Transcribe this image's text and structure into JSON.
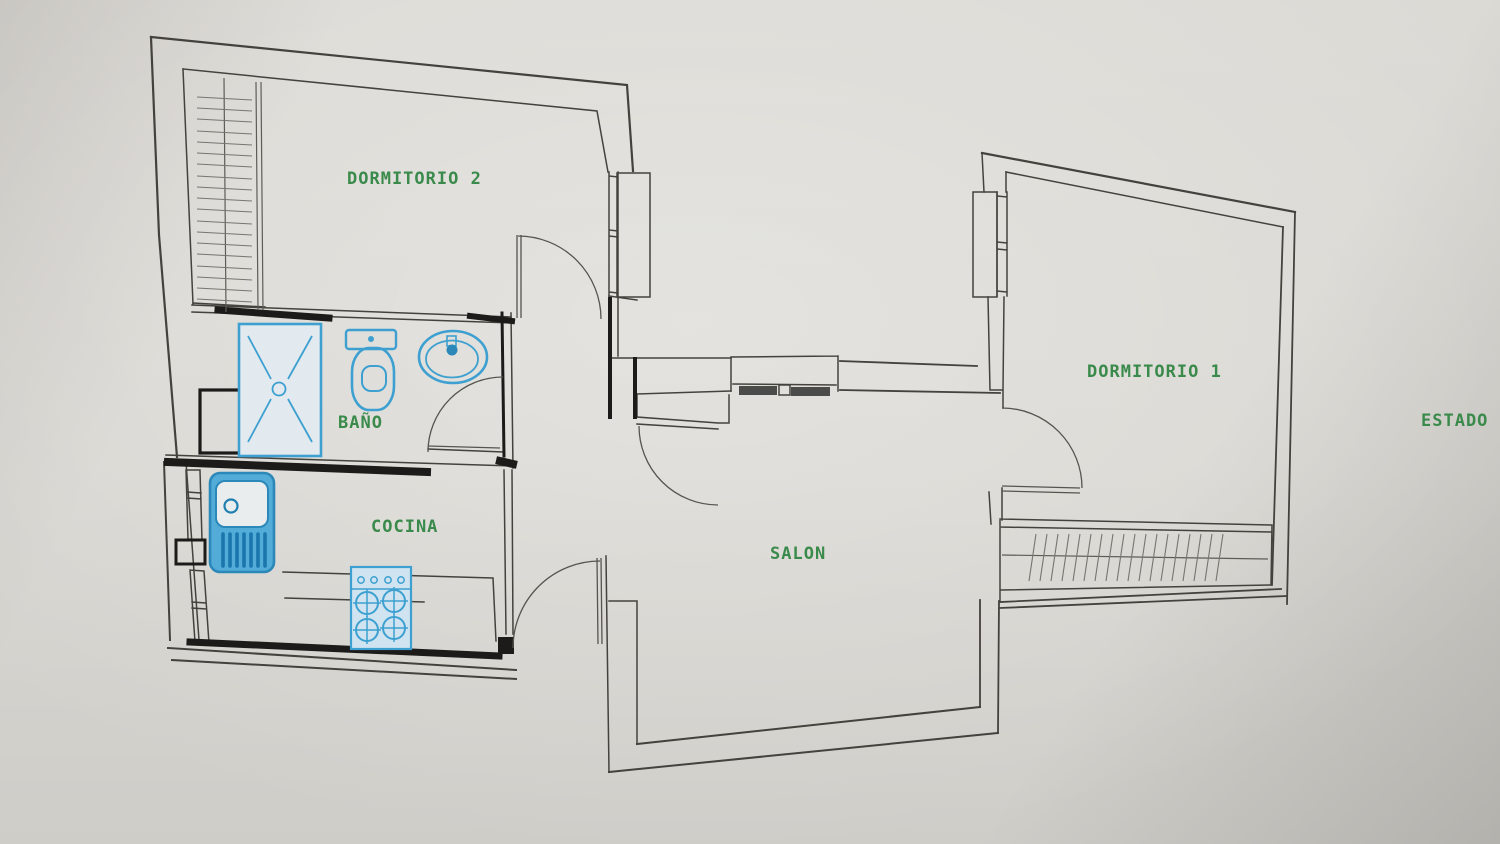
{
  "plan": {
    "type": "apartment-floor-plan",
    "rooms": [
      {
        "label": "DORMITORIO 2"
      },
      {
        "label": "BAÑO"
      },
      {
        "label": "COCINA"
      },
      {
        "label": "SALON"
      },
      {
        "label": "DORMITORIO 1"
      }
    ],
    "annotation": {
      "label": "ESTADO"
    },
    "colors": {
      "paper": "#d9d7d2",
      "wall_line": "#44423d",
      "wall_heavy": "#1c1b19",
      "fixture_blue": "#3da0d0",
      "fixture_blue_dark": "#2b88b8",
      "fixture_fill_light": "#d6e7f1",
      "sink_fill": "#53abd8",
      "label_green": "#3a8a4b",
      "hatch_gray": "#76756f",
      "window_bar": "#4b4b49"
    }
  }
}
